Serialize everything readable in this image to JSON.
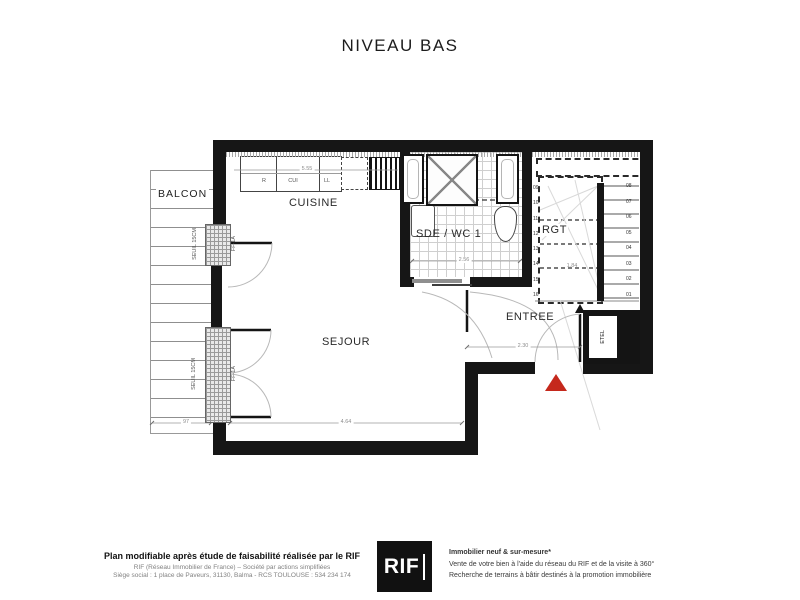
{
  "title": "NIVEAU BAS",
  "plan": {
    "rooms": {
      "balcon": "BALCON",
      "cuisine": "CUISINE",
      "sde": "SDE / WC 1",
      "rgt": "RGT",
      "sejour": "SEJOUR",
      "entree": "ENTREE"
    },
    "appliances": {
      "r": "R",
      "cui": "CUI",
      "ll": "LL"
    },
    "windows": {
      "seuil_top": "SEUIL 15CM",
      "tag_top": "FF-1A",
      "seuil_bottom": "SEUIL 15CM",
      "tag_bottom": "FF-1A"
    },
    "tech": {
      "etel": "ETEL"
    },
    "dimensions": {
      "kitchen_width": "5.55",
      "sde_width": "2.56",
      "entree_width": "2.30",
      "sejour_width": "4.64",
      "balcony_depth": "97",
      "stair_width": "1.84"
    },
    "stairs": {
      "lower_steps": [
        "01",
        "02",
        "03",
        "04",
        "05",
        "06",
        "07",
        "08"
      ],
      "upper_steps": [
        "09",
        "10",
        "11",
        "12",
        "13",
        "14",
        "15",
        "16"
      ]
    },
    "colors": {
      "walls": "#161616",
      "entry_marker": "#c5281c",
      "logo_bg": "#111111"
    }
  },
  "footer": {
    "left": {
      "line1": "Plan modifiable après étude de faisabilité réalisée par le RIF",
      "line2": "RIF (Réseau Immobilier de France) – Société par actions simplifiées",
      "line3": "Siège social : 1 place de Paveurs, 31130, Balma - RCS TOULOUSE : 534 234 174"
    },
    "logo": "RIF",
    "right": {
      "line1": "Immobilier neuf & sur-mesure*",
      "line2": "Vente de votre bien à l'aide du réseau du RIF et de la visite à 360°",
      "line3": "Recherche de terrains à bâtir destinés à la promotion immobilière"
    }
  }
}
